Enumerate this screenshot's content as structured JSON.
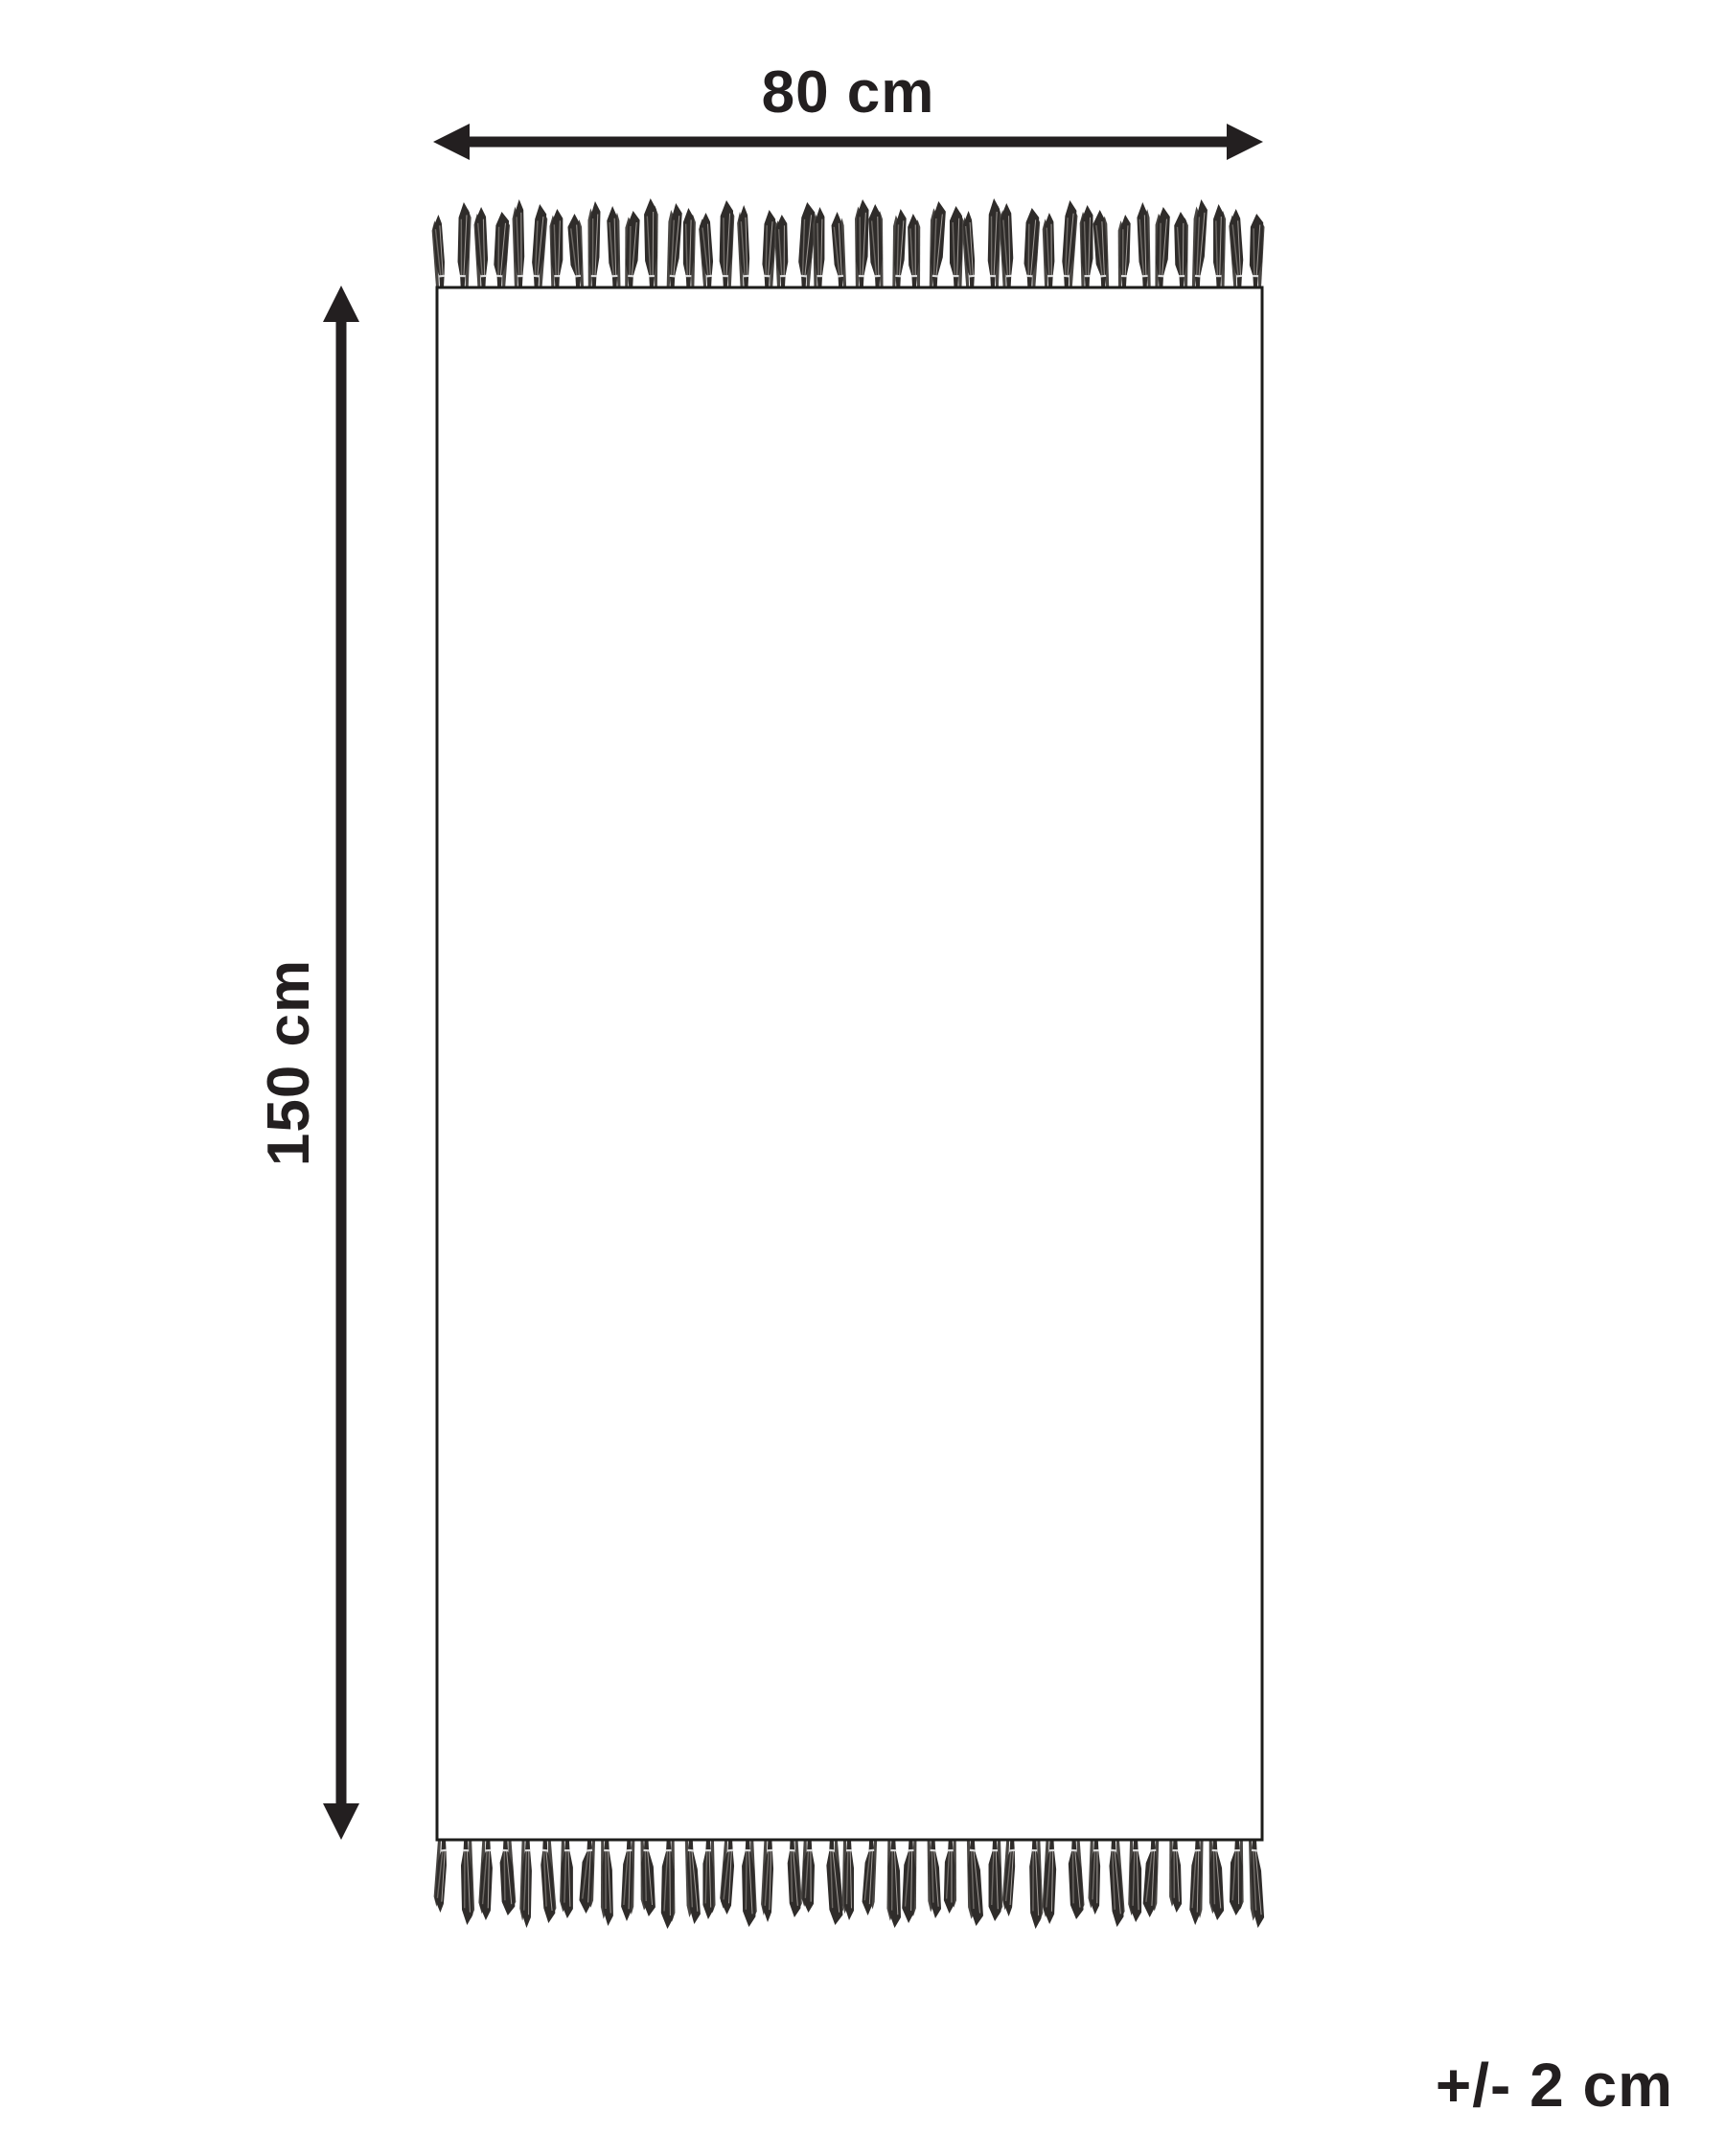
{
  "diagram": {
    "width_label": "80 cm",
    "height_label": "150 cm",
    "tolerance_label": "+/- 2 cm"
  },
  "colors": {
    "line": "#231f20",
    "rug_outline": "#1d1d1b",
    "rug_fill": "#ffffff",
    "background": "#ffffff",
    "tassel_dark": "#2f2c2a",
    "tassel_secondary": "#4a4744",
    "tassel_strand_mid": "#6e6a66",
    "tassel_strand_light": "#a29d99",
    "tassel_tie": "#d8d8d8"
  },
  "fringe": {
    "top_count": 44,
    "bottom_count": 41
  }
}
